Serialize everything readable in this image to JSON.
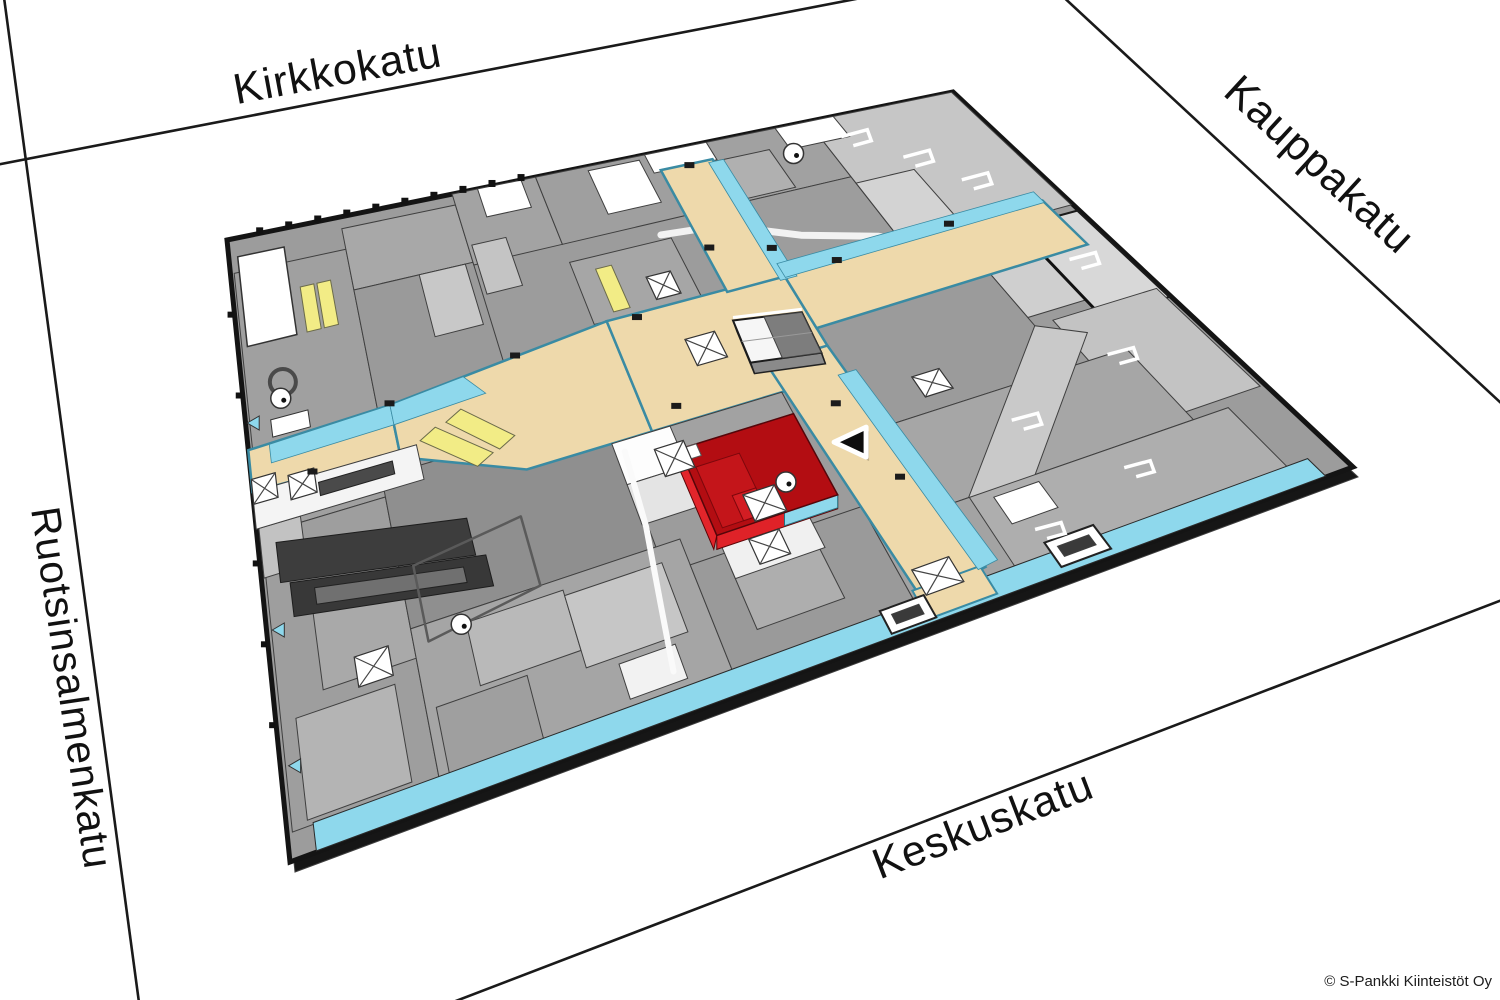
{
  "streets": {
    "north": {
      "label": "Kirkkokatu"
    },
    "east": {
      "label": "Kauppakatu"
    },
    "west": {
      "label": "Ruotsinsalmenkatu"
    },
    "south": {
      "label": "Keskuskatu"
    }
  },
  "attribution": {
    "label": "© S-Pankki Kiinteistöt Oy"
  },
  "map": {
    "marker_icon": "location-triangle-icon",
    "highlighted_unit": "red-unit",
    "colors": {
      "background": "#ffffff",
      "street_line": "#1a1a1a",
      "base_gray": "#9c9c9c",
      "outline_black": "#141414",
      "wall_gray": "#3f3f3f",
      "corridor_tan": "#eed9ab",
      "glass_cyan": "#8ed8ec",
      "glass_edge": "#3a8ba3",
      "highlight_red_top": "#b30d12",
      "highlight_red_side": "#e2252b",
      "escalator_yellow": "#f2ec86",
      "stripe_dark": "#3d3d3d"
    }
  }
}
